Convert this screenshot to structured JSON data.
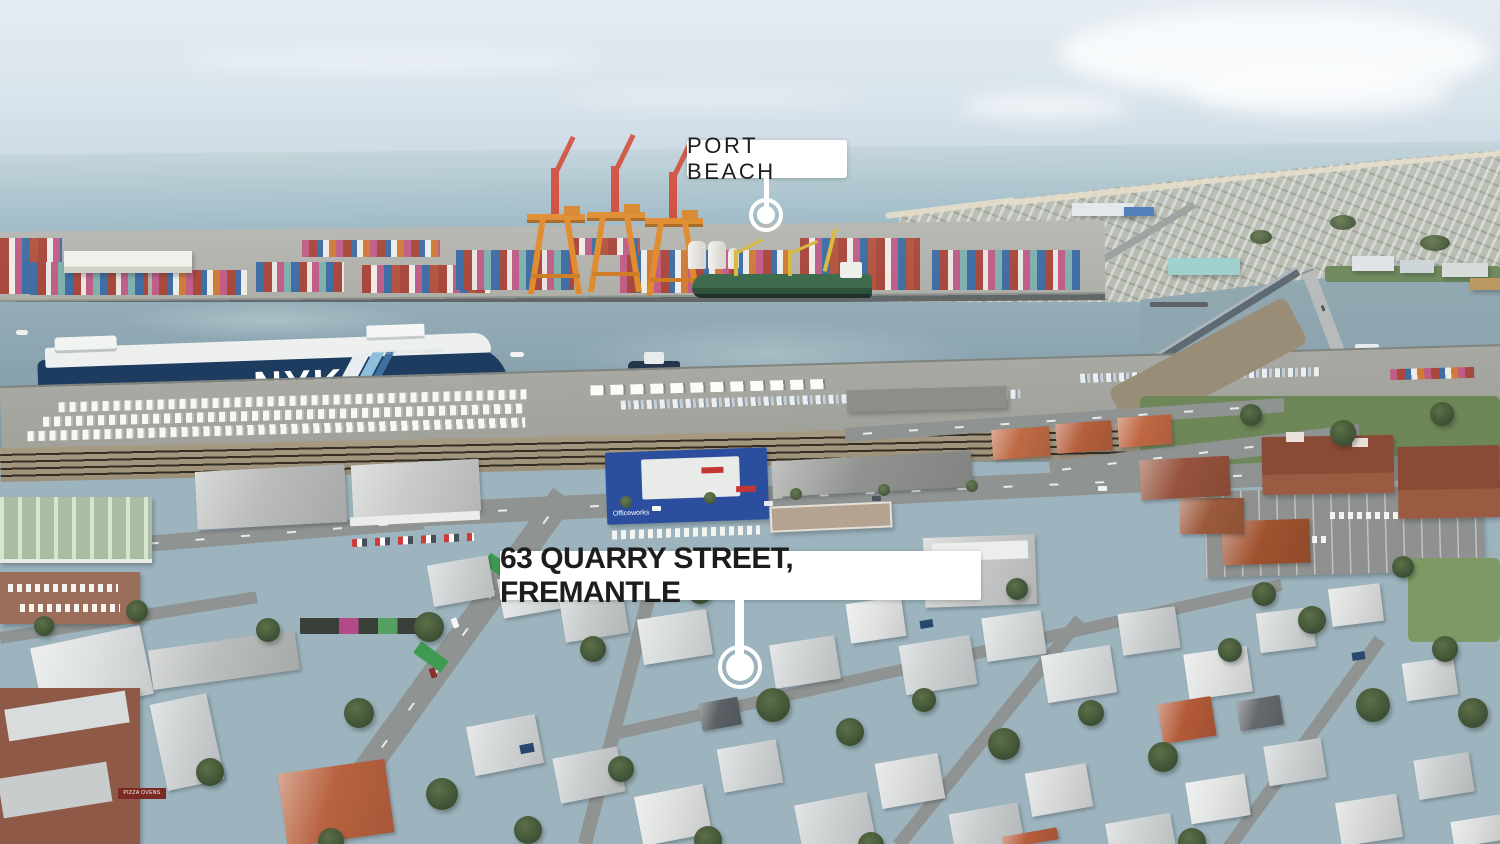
{
  "annotations": {
    "port_beach": {
      "label": "PORT BEACH"
    },
    "property": {
      "label": "63 QUARRY STREET, FREMANTLE"
    }
  },
  "photo_text": {
    "ship_brand": "NYK",
    "ship_brand_suffix": "LINE",
    "ship_name": "PROMETHEUS LEADER",
    "officeworks_sign": "Officeworks",
    "pizza_sign": "PIZZA OVENS"
  },
  "style": {
    "label_background": "#ffffff",
    "label_text_color": "#1d1d1b",
    "marker_color": "#ffffff",
    "ship_hull_navy": "#1d3c60",
    "crane_red": "#cf4a38",
    "crane_orange": "#e08a2b",
    "officeworks_blue": "#2b4f9e",
    "ocean_blue_gray": "#93b0bd"
  }
}
